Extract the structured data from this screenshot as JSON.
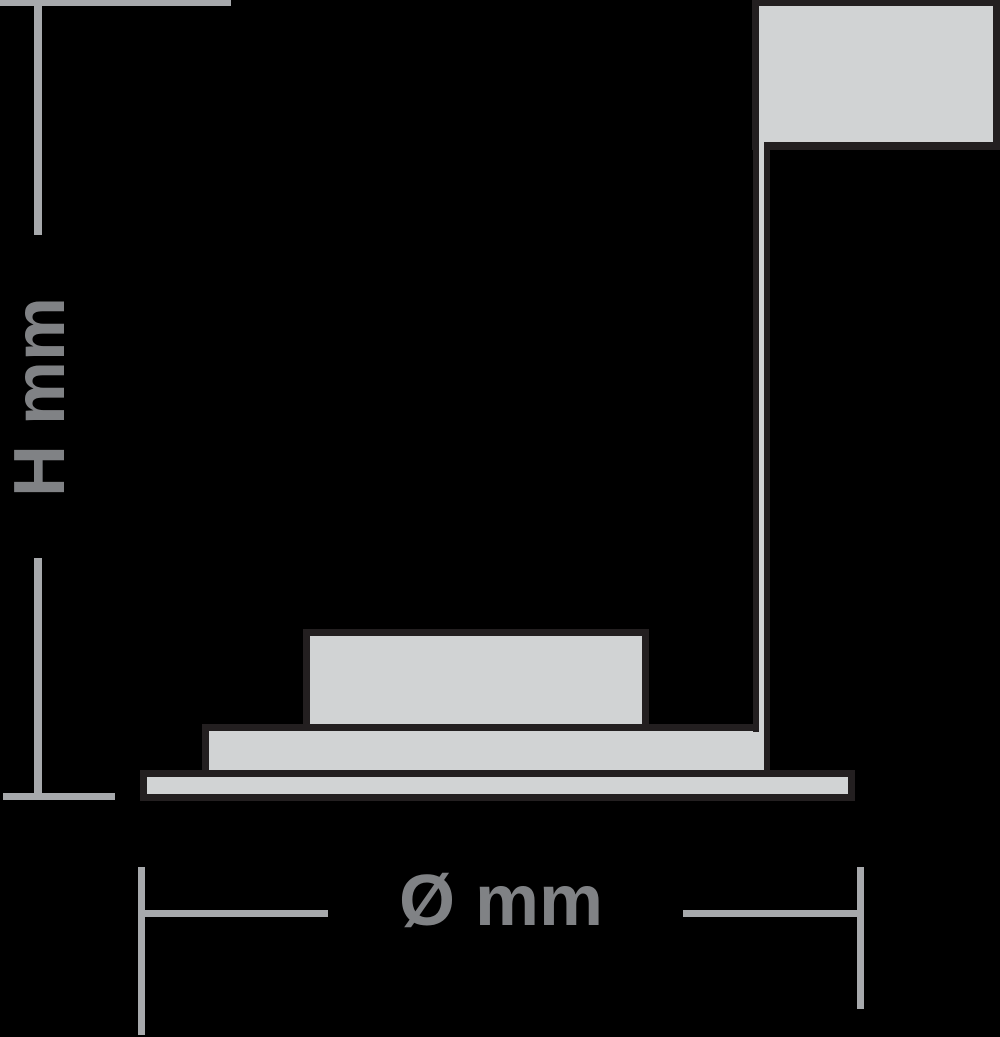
{
  "diagram": {
    "background_color": "#000000",
    "outline_color": "#231f20",
    "fill_color": "#d1d3d4",
    "dimension_line_color": "#a7a9ac",
    "dimension_text_color": "#808285",
    "height_dimension": {
      "label": "H mm"
    },
    "diameter_dimension": {
      "label": "Ø mm"
    }
  }
}
